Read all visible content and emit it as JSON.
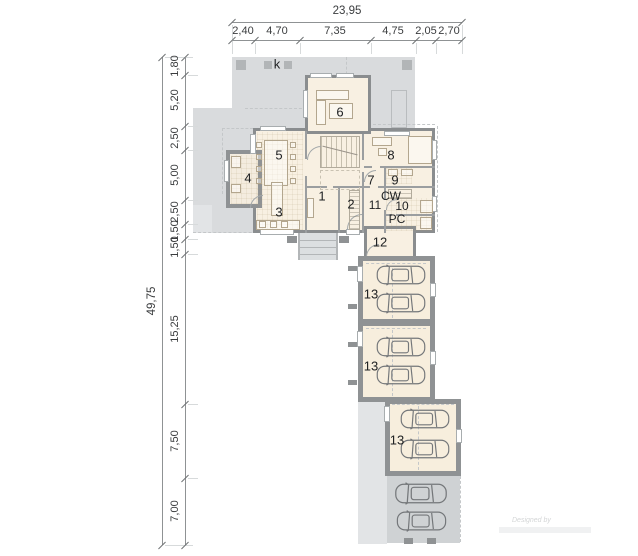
{
  "plan": {
    "column_mark": "k",
    "watermark": "Designed by",
    "rooms": [
      {
        "label": "6"
      },
      {
        "label": "5"
      },
      {
        "label": "8"
      },
      {
        "label": "4"
      },
      {
        "label": "7"
      },
      {
        "label": "9"
      },
      {
        "label": "CW"
      },
      {
        "label": "11"
      },
      {
        "label": "10"
      },
      {
        "label": "PC"
      },
      {
        "label": "3"
      },
      {
        "label": "1"
      },
      {
        "label": "2"
      },
      {
        "label": "12"
      },
      {
        "label": "13"
      },
      {
        "label": "13"
      },
      {
        "label": "13"
      }
    ]
  },
  "dimensions": {
    "top": {
      "total": "23,95",
      "segments": [
        "2,40",
        "4,70",
        "7,35",
        "4,75",
        "2,05",
        "2,70"
      ]
    },
    "left": {
      "total": "49,75",
      "segments": [
        "1,80",
        "5,20",
        "2,50",
        "5,00",
        "2,50",
        "1,50",
        "1,50",
        "15,25",
        "7,50",
        "7,00"
      ]
    }
  },
  "colors": {
    "terrace": "#d9dbdd",
    "floor": "#f8f0e2",
    "wall": "#8a8d8f",
    "garage_wall": "#8f9294",
    "parking": "#cfd2d4"
  }
}
